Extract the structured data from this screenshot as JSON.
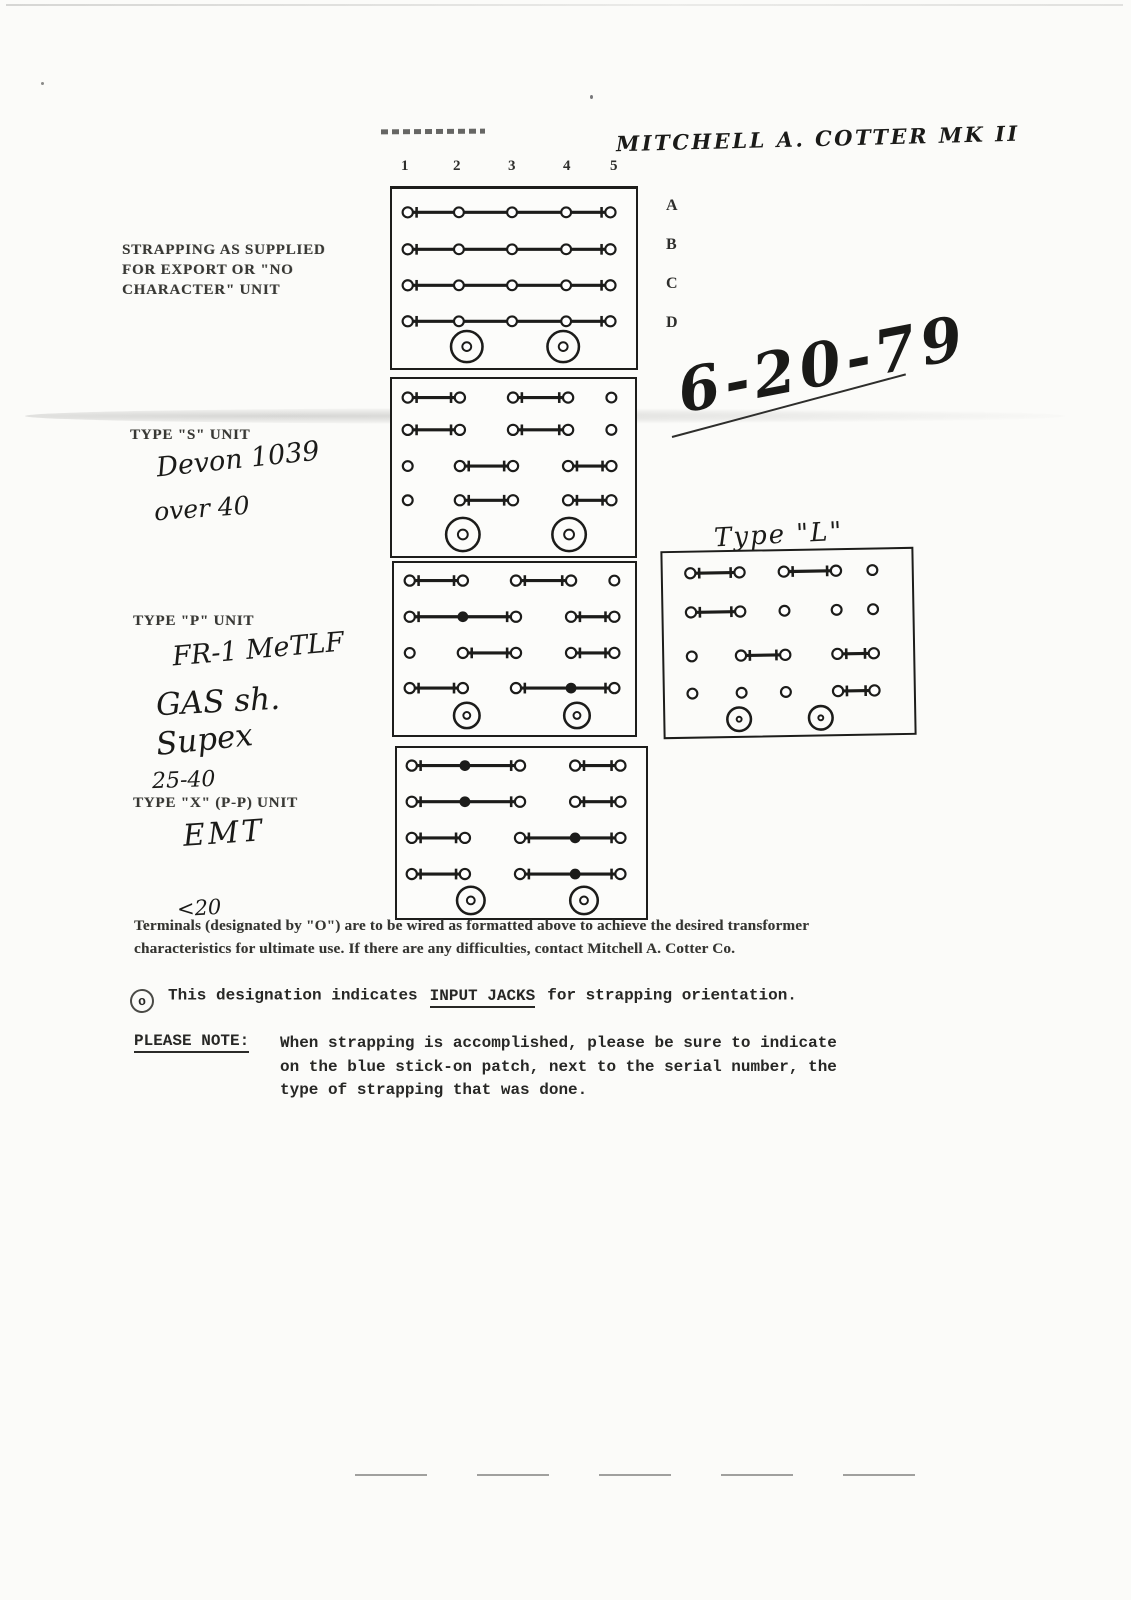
{
  "header": {
    "handwritten_title": "MITCHELL A. COTTER  MK II",
    "handwritten_date": "6-20-79"
  },
  "grid": {
    "column_numbers": [
      "1",
      "2",
      "3",
      "4",
      "5"
    ],
    "row_letters": [
      "A",
      "B",
      "C",
      "D"
    ]
  },
  "labels": {
    "export": {
      "line1": "STRAPPING AS  SUPPLIED",
      "line2": "FOR EXPORT OR \"NO",
      "line3": "CHARACTER\" UNIT"
    },
    "type_s": {
      "title": "TYPE \"S\" UNIT",
      "hw1": "Devon  1039",
      "hw2": "over 40"
    },
    "type_p": {
      "title": "TYPE \"P\" UNIT",
      "hw1": "FR-1  MeTLF",
      "hw2": "GAS  sh.",
      "hw3": "Supex",
      "hw4": "25-40"
    },
    "type_x": {
      "title": "TYPE \"X\" (P-P) UNIT",
      "hw1": "EMT",
      "hw2": "<20"
    },
    "type_l": {
      "title": "Type \"L\""
    }
  },
  "diagrams": {
    "export": {
      "rows": [
        [
          [
            1,
            5
          ]
        ],
        [
          [
            1,
            5
          ]
        ],
        [
          [
            1,
            5
          ]
        ],
        [
          [
            1,
            5
          ]
        ]
      ],
      "jacks": [
        2,
        4
      ]
    },
    "type_s": {
      "rows": [
        [
          [
            1,
            2
          ],
          [
            3,
            4
          ],
          [
            5
          ]
        ],
        [
          [
            1,
            2
          ],
          [
            3,
            4
          ],
          [
            5
          ]
        ],
        [
          [
            1
          ],
          [
            2,
            3
          ],
          [
            4,
            5
          ]
        ],
        [
          [
            1
          ],
          [
            2,
            3
          ],
          [
            4,
            5
          ]
        ]
      ],
      "jacks": [
        2,
        4
      ]
    },
    "type_p": {
      "rows": [
        [
          [
            1,
            2
          ],
          [
            3,
            4
          ],
          [
            5
          ]
        ],
        [
          [
            1,
            3
          ],
          [
            4,
            5
          ]
        ],
        [
          [
            1
          ],
          [
            2,
            3
          ],
          [
            4,
            5
          ]
        ],
        [
          [
            1,
            2
          ],
          [
            3,
            5
          ]
        ]
      ],
      "jacks": [
        2,
        4
      ]
    },
    "type_l": {
      "rows": [
        [
          [
            1,
            2
          ],
          [
            3,
            4
          ],
          [
            5
          ]
        ],
        [
          [
            1,
            2
          ],
          [
            3
          ],
          [
            4
          ],
          [
            5
          ]
        ],
        [
          [
            1
          ],
          [
            2,
            3
          ],
          [
            4,
            5
          ]
        ],
        [
          [
            1
          ],
          [
            2
          ],
          [
            3
          ],
          [
            4,
            5
          ]
        ]
      ],
      "jacks": [
        2,
        4
      ]
    },
    "type_x": {
      "rows": [
        [
          [
            1,
            3
          ],
          [
            4,
            5
          ]
        ],
        [
          [
            1,
            3
          ],
          [
            4,
            5
          ]
        ],
        [
          [
            1,
            2
          ],
          [
            3,
            5
          ]
        ],
        [
          [
            1,
            2
          ],
          [
            3,
            5
          ]
        ]
      ],
      "jacks": [
        2,
        4
      ]
    }
  },
  "notes": {
    "terminals_note_1": "Terminals (designated by \"O\") are to be wired as formatted above to achieve the desired  transformer",
    "terminals_note_2": "characteristics for ultimate use.  If there are any difficulties, contact Mitchell A. Cotter Co.",
    "jack_symbol": "o",
    "jack_note_prefix": "This designation indicates",
    "jack_note_underlined": "INPUT  JACKS",
    "jack_note_suffix": "for strapping orientation.",
    "please_note_label": "PLEASE NOTE:",
    "please_note_line1": "When strapping is accomplished, please be sure to indicate",
    "please_note_line2": "on the blue stick-on patch, next to the serial number, the",
    "please_note_line3": "type of strapping that was done."
  }
}
